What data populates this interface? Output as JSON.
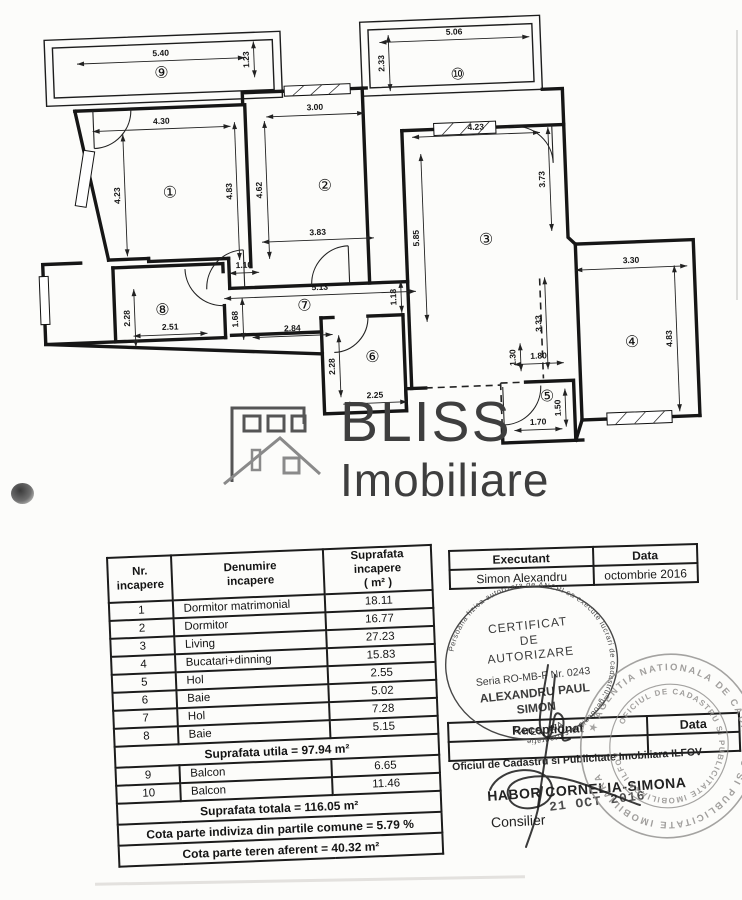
{
  "plan": {
    "room_labels": [
      {
        "n": "①",
        "x": 172,
        "y": 184
      },
      {
        "n": "②",
        "x": 327,
        "y": 183
      },
      {
        "n": "③",
        "x": 486,
        "y": 243
      },
      {
        "n": "④",
        "x": 628,
        "y": 351
      },
      {
        "n": "⑤",
        "x": 541,
        "y": 402
      },
      {
        "n": "⑥",
        "x": 368,
        "y": 356
      },
      {
        "n": "⑦",
        "x": 302,
        "y": 302
      },
      {
        "n": "⑧",
        "x": 160,
        "y": 301
      },
      {
        "n": "⑨",
        "x": 168,
        "y": 64
      },
      {
        "n": "⑩",
        "x": 464,
        "y": 77
      }
    ],
    "dims": [
      {
        "t": "5.40",
        "x": 168,
        "y": 50,
        "v": 0,
        "l": 168
      },
      {
        "t": "1.23",
        "x": 258,
        "y": 55,
        "v": 1,
        "l": 36
      },
      {
        "t": "4.30",
        "x": 166,
        "y": 118,
        "v": 0,
        "l": 138
      },
      {
        "t": "4.23",
        "x": 124,
        "y": 186,
        "v": 1,
        "l": 122
      },
      {
        "t": "4.83",
        "x": 236,
        "y": 186,
        "v": 1,
        "l": 138
      },
      {
        "t": "3.00",
        "x": 320,
        "y": 110,
        "v": 0,
        "l": 98
      },
      {
        "t": "4.62",
        "x": 266,
        "y": 186,
        "v": 1,
        "l": 138
      },
      {
        "t": "3.83",
        "x": 318,
        "y": 235,
        "v": 0,
        "l": 112
      },
      {
        "t": "1.10",
        "x": 243,
        "y": 265,
        "v": 0,
        "l": 30
      },
      {
        "t": "5.06",
        "x": 462,
        "y": 40,
        "v": 0,
        "l": 150
      },
      {
        "t": "2.33",
        "x": 393,
        "y": 64,
        "v": 1,
        "l": 56
      },
      {
        "t": "4.23",
        "x": 480,
        "y": 136,
        "v": 0,
        "l": 128
      },
      {
        "t": "3.73",
        "x": 549,
        "y": 186,
        "v": 1,
        "l": 104
      },
      {
        "t": "5.85",
        "x": 421,
        "y": 240,
        "v": 1,
        "l": 168
      },
      {
        "t": "3.30",
        "x": 630,
        "y": 275,
        "v": 0,
        "l": 112
      },
      {
        "t": "4.83",
        "x": 670,
        "y": 350,
        "v": 1,
        "l": 146
      },
      {
        "t": "5.13",
        "x": 318,
        "y": 290,
        "v": 0,
        "l": 192
      },
      {
        "t": "1.68",
        "x": 237,
        "y": 314,
        "v": 1,
        "l": 42
      },
      {
        "t": "2.84",
        "x": 289,
        "y": 330,
        "v": 0,
        "l": 80
      },
      {
        "t": "1.18",
        "x": 396,
        "y": 298,
        "v": 1,
        "l": 32
      },
      {
        "t": "2.28",
        "x": 129,
        "y": 309,
        "v": 1,
        "l": 58
      },
      {
        "t": "2.51",
        "x": 167,
        "y": 324,
        "v": 0,
        "l": 74
      },
      {
        "t": "2.28",
        "x": 332,
        "y": 365,
        "v": 1,
        "l": 62
      },
      {
        "t": "2.25",
        "x": 369,
        "y": 400,
        "v": 0,
        "l": 64
      },
      {
        "t": "3.33",
        "x": 540,
        "y": 330,
        "v": 1,
        "l": 92
      },
      {
        "t": "1.30",
        "x": 513,
        "y": 363,
        "v": 1,
        "l": 28
      },
      {
        "t": "1.80",
        "x": 534,
        "y": 367,
        "v": 0,
        "l": 50
      },
      {
        "t": "1.50",
        "x": 556,
        "y": 415,
        "v": 1,
        "l": 38
      },
      {
        "t": "1.70",
        "x": 531,
        "y": 433,
        "v": 0,
        "l": 48
      }
    ]
  },
  "watermark": {
    "brand": "BLISS",
    "subtitle": "Imobiliare"
  },
  "area_table": {
    "header_nr": "Nr.\nincapere",
    "header_denumire": "Denumire\nincapere",
    "header_suprafata": "Suprafata incapere\n( m² )",
    "rows": [
      [
        "1",
        "Dormitor matrimonial",
        "18.11"
      ],
      [
        "2",
        "Dormitor",
        "16.77"
      ],
      [
        "3",
        "Living",
        "27.23"
      ],
      [
        "4",
        "Bucatari+dinning",
        "15.83"
      ],
      [
        "5",
        "Hol",
        "2.55"
      ],
      [
        "6",
        "Baie",
        "5.02"
      ],
      [
        "7",
        "Hol",
        "7.28"
      ],
      [
        "8",
        "Baie",
        "5.15"
      ]
    ],
    "suprafata_utila": "Suprafata utila = 97.94 m²",
    "balcony_rows": [
      [
        "9",
        "Balcon",
        "6.65"
      ],
      [
        "10",
        "Balcon",
        "11.46"
      ]
    ],
    "suprafata_totala": "Suprafata totala = 116.05 m²",
    "cota_comune": "Cota parte indiviza din partile comune = 5.79 %",
    "cota_teren": "Cota parte teren aferent = 40.32 m²"
  },
  "executant_table": {
    "col1_header": "Executant",
    "col2_header": "Data",
    "col1_value": "Simon Alexandru",
    "col2_value": "octombrie 2016"
  },
  "stamp_certificat": {
    "line1": "CERTIFICAT",
    "line2": "DE",
    "line3": "AUTORIZARE",
    "line4": "Seria RO-MB-F Nr. 0243",
    "line5": "ALEXANDRU PAUL",
    "line6": "SIMON",
    "line7": "CATEGORIA",
    "ring_text": "Persoana fizica autorizata de ANCPI sa execute lucrari de cadastru, geodezie si cartografie"
  },
  "stamp_ocpi": {
    "outer_text": "AGENTIA NATIONALA DE CADASTRU SI PUBLICITATE IMOBILIARA",
    "inner_text": "OFICIUL DE CADASTRU SI PUBLICITATE IMOBILIARA ILFOV",
    "star": "★"
  },
  "receptionat_table": {
    "col1_header": "Receptionat",
    "col2_header": "Data"
  },
  "registry": {
    "office_line": "Oficiul de Cadastru si Publicitate Imobiliara ILFOV",
    "officer_name": "HABOR CORNELIA-SIMONA",
    "date_stamp": "21 OCT 2016",
    "officer_title": "Consilier"
  }
}
